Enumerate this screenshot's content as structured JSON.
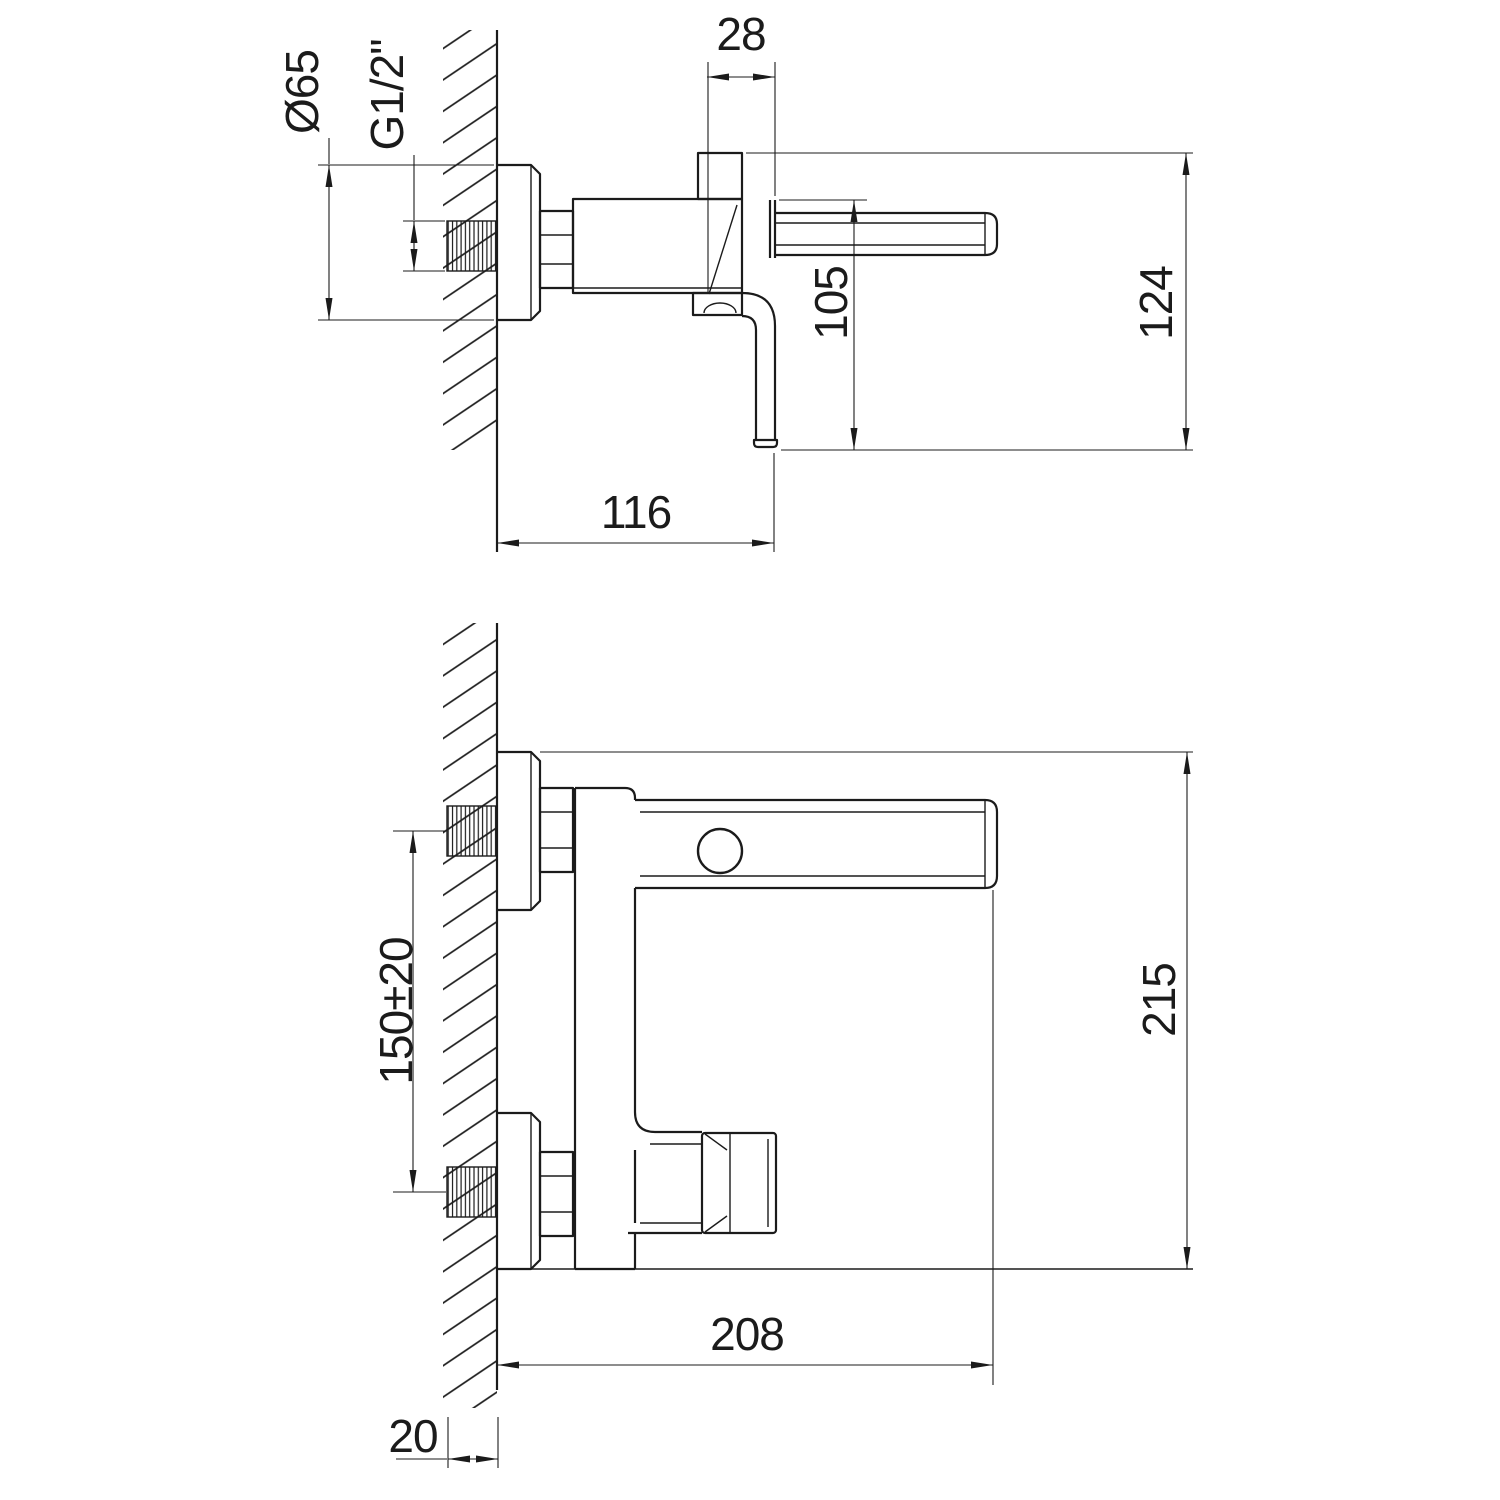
{
  "colors": {
    "background": "#ffffff",
    "line": "#1b1b1b"
  },
  "drawing": {
    "kind": "faucet-installation-technical-drawing",
    "views": [
      "side-section-view",
      "plan-view"
    ]
  },
  "dims": {
    "dia65": "Ø65",
    "g_half": "G1/2\"",
    "d28": "28",
    "d105": "105",
    "d124": "124",
    "d116": "116",
    "d150": "150±20",
    "d215": "215",
    "d208": "208",
    "d20": "20"
  }
}
